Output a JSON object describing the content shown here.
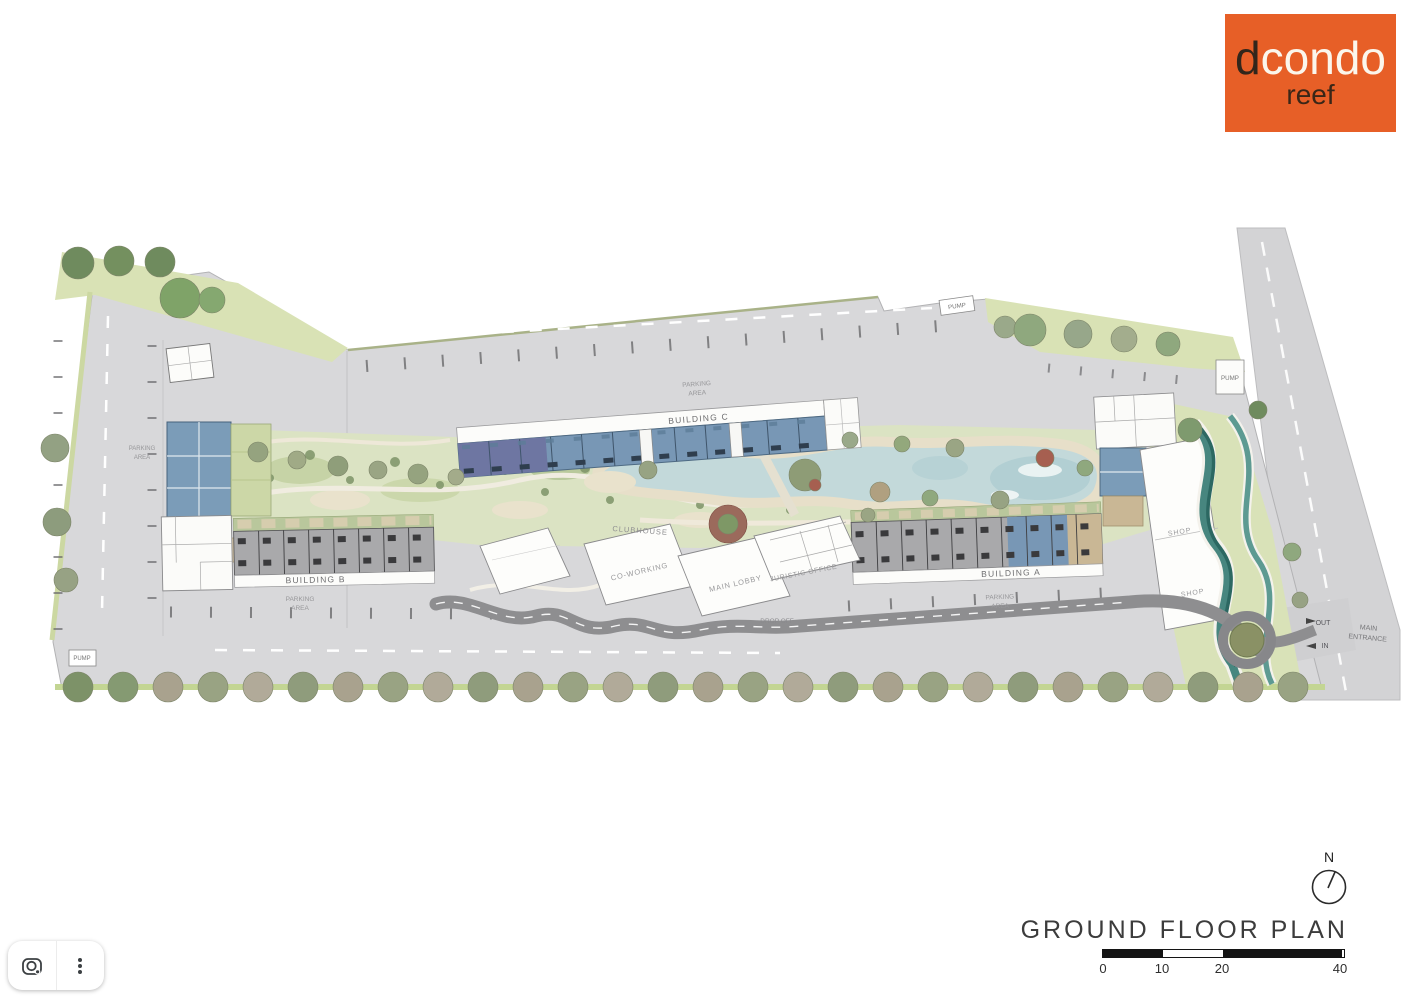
{
  "logo": {
    "d": "d",
    "condo": "condo",
    "sub": "reef"
  },
  "plan": {
    "building_a": "BUILDING A",
    "building_b": "BUILDING B",
    "building_c": "BUILDING C",
    "clubhouse": "CLUBHOUSE",
    "coworking": "CO-WORKING",
    "main_lobby": "MAIN LOBBY",
    "juristic_office": "JURISTIC OFFICE",
    "parking_line1": "PARKING",
    "parking_line2": "AREA",
    "shop": "SHOP",
    "pump": "PUMP",
    "drop_off": "DROP OFF",
    "out": "OUT",
    "in": "IN",
    "entrance_line1": "MAIN",
    "entrance_line2": "ENTRANCE"
  },
  "title_block": {
    "title": "GROUND FLOOR PLAN",
    "north_label": "N",
    "scale_ticks": [
      "0",
      "10",
      "20",
      "40"
    ]
  },
  "colors": {
    "brand_orange": "#E75F27",
    "pool_water": "#C3D9DA",
    "landscape_green": "#D9E2B5",
    "parking_gray": "#D8D8DA",
    "unit_blue": "#7897B5",
    "unit_purple": "#6E76A2",
    "stream_teal": "#47867F"
  }
}
